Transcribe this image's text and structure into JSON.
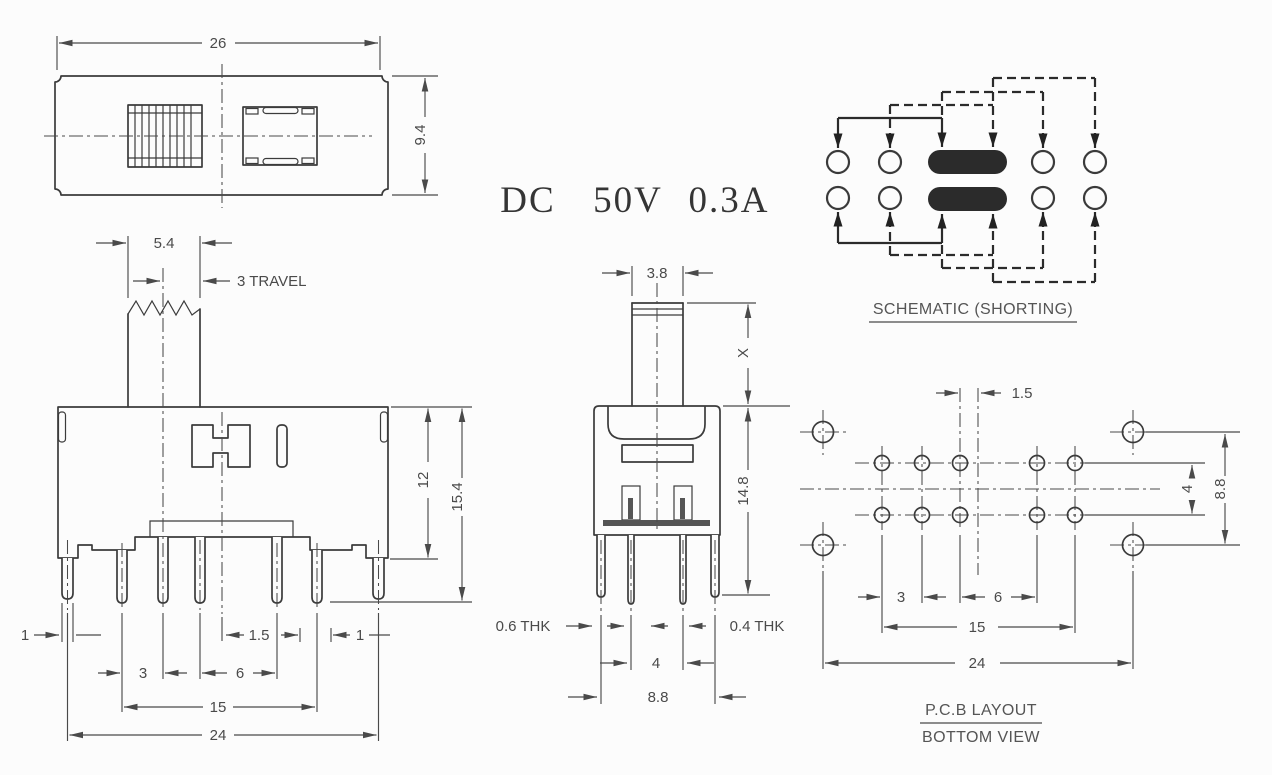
{
  "rating": {
    "dc": "DC",
    "voltage": "50V",
    "current": "0.3A"
  },
  "top_view": {
    "width": "26",
    "height": "9.4"
  },
  "front_view": {
    "knob_width": "5.4",
    "travel": "3 TRAVEL",
    "upper_height": "12",
    "total_height": "15.4",
    "left_clip": "1",
    "center_offset": "1.5",
    "right_clip": "1",
    "pitch_small": "3",
    "pitch_large": "6",
    "pin_span": "15",
    "overall": "24"
  },
  "side_view": {
    "knob_width": "3.8",
    "knob_height": "X",
    "body_height": "14.8",
    "left_thickness": "0.6 THK",
    "right_thickness": "0.4 THK",
    "pin_gap": "4",
    "clip_gap": "8.8"
  },
  "schematic": {
    "title": "SCHEMATIC (SHORTING)"
  },
  "pcb": {
    "title": "P.C.B LAYOUT",
    "subtitle": "BOTTOM VIEW",
    "center_offset": "1.5",
    "row_gap": "4",
    "corner_gap": "8.8",
    "pitch_small": "3",
    "pitch_large": "6",
    "span": "15",
    "overall": "24"
  }
}
